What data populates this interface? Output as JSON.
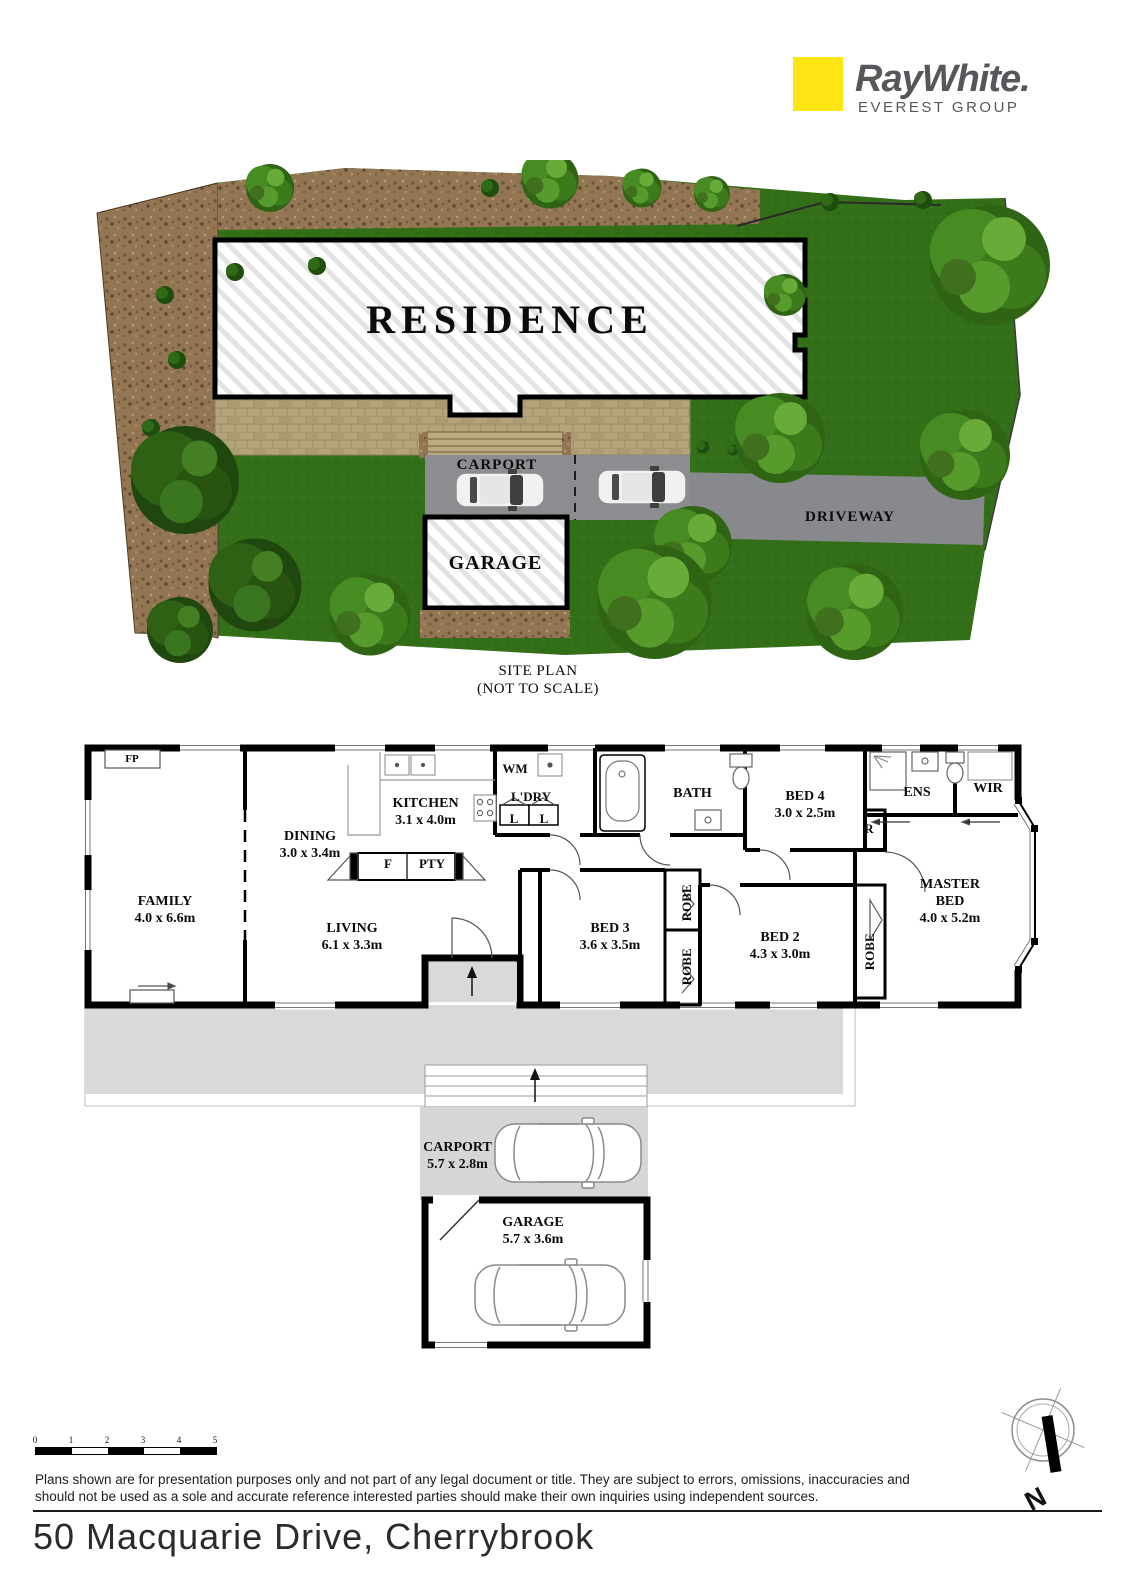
{
  "branding": {
    "brand_name": "RayWhite.",
    "group_name": "EVEREST GROUP",
    "brand_yellow": "#ffe512"
  },
  "site_plan": {
    "residence": "RESIDENCE",
    "carport": "CARPORT",
    "garage": "GARAGE",
    "driveway": "DRIVEWAY",
    "caption_line1": "SITE PLAN",
    "caption_line2": "(NOT TO SCALE)"
  },
  "floor_plan": {
    "fp": "FP",
    "family": {
      "name": "FAMILY",
      "dims": "4.0 x 6.6m"
    },
    "dining": {
      "name": "DINING",
      "dims": "3.0 x 3.4m"
    },
    "kitchen": {
      "name": "KITCHEN",
      "dims": "3.1 x 4.0m"
    },
    "living": {
      "name": "LIVING",
      "dims": "6.1 x 3.3m"
    },
    "wm": "WM",
    "ldry": "L'DRY",
    "linen1": "L",
    "linen2": "L",
    "fridge": "F",
    "pantry": "PTY",
    "bath": "BATH",
    "bed4": {
      "name": "BED 4",
      "dims": "3.0 x 2.5m"
    },
    "robe_r": "R",
    "ens": "ENS",
    "wir": "WIR",
    "master": {
      "name": "MASTER BED",
      "dims": "4.0 x 5.2m"
    },
    "bed3": {
      "name": "BED 3",
      "dims": "3.6 x 3.5m"
    },
    "bed2": {
      "name": "BED 2",
      "dims": "4.3 x 3.0m"
    },
    "robe1": "ROBE",
    "robe2": "ROBE",
    "robe3": "ROBE",
    "carport": {
      "name": "CARPORT",
      "dims": "5.7 x 2.8m"
    },
    "garage": {
      "name": "GARAGE",
      "dims": "5.7 x 3.6m"
    }
  },
  "footer": {
    "scale_ticks": [
      "0",
      "1",
      "2",
      "3",
      "4",
      "5"
    ],
    "compass": "N",
    "disclaimer_line1": "Plans shown are for presentation purposes only and not part of any legal document or title. They are subject to errors, omissions, inaccuracies and",
    "disclaimer_line2": "should not be used as a sole and accurate reference interested parties should make their own inquiries using independent sources.",
    "address": "50 Macquarie Drive, Cherrybrook"
  }
}
